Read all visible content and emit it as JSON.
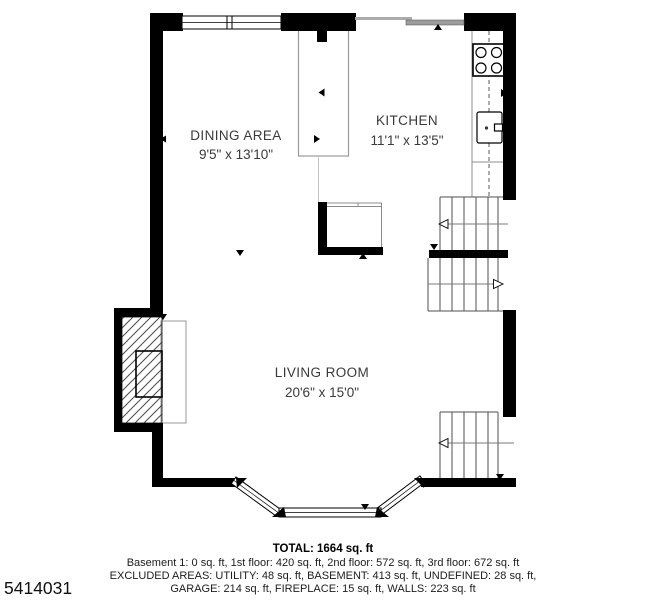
{
  "page": {
    "plan_id": "5414031",
    "background": "#ffffff"
  },
  "rooms": {
    "dining": {
      "name": "DINING AREA",
      "dims": "9'5\" x 13'10\""
    },
    "kitchen": {
      "name": "KITCHEN",
      "dims": "11'1\" x 13'5\""
    },
    "living": {
      "name": "LIVING ROOM",
      "dims": "20'6\" x 15'0\""
    }
  },
  "summary": {
    "total": "TOTAL: 1664 sq. ft",
    "floors": "Basement 1: 0 sq. ft, 1st floor: 420 sq. ft, 2nd floor: 572 sq. ft, 3rd floor: 672 sq. ft",
    "excluded_line1": "EXCLUDED AREAS: UTILITY: 48 sq. ft, BASEMENT: 413 sq. ft, UNDEFINED: 28 sq. ft,",
    "excluded_line2": "GARAGE: 214 sq. ft, FIREPLACE: 15 sq. ft, WALLS: 223 sq. ft"
  },
  "colors": {
    "wall": "#000000",
    "fixture_line": "#8c8c8c",
    "stair_line": "#4f4f4f",
    "label_text": "#3a3a3a",
    "summary_text": "#1c1c1c"
  }
}
